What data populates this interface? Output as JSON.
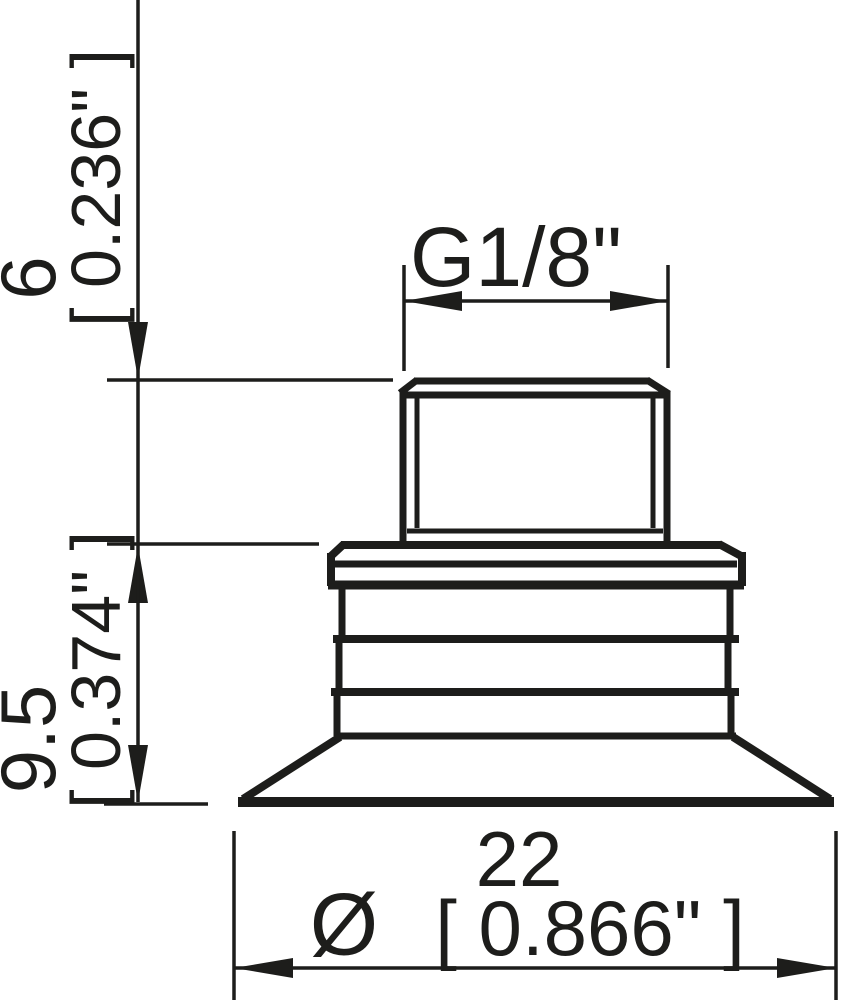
{
  "drawing": {
    "description": "Technical line drawing of a flat suction cup with threaded fitting, side view with dimensions",
    "line_color": "#1d1d1b",
    "background_color": "#ffffff",
    "dimensions": {
      "thread": {
        "label": "G1/8\""
      },
      "height_top": {
        "mm": "6",
        "inch_bracket": "[ 0.236\" ]"
      },
      "height_body": {
        "mm": "9.5",
        "inch_bracket": "[ 0.374\" ]"
      },
      "diameter": {
        "symbol": "Ø",
        "mm": "22",
        "inch_bracket": "[ 0.866\" ]"
      }
    }
  }
}
